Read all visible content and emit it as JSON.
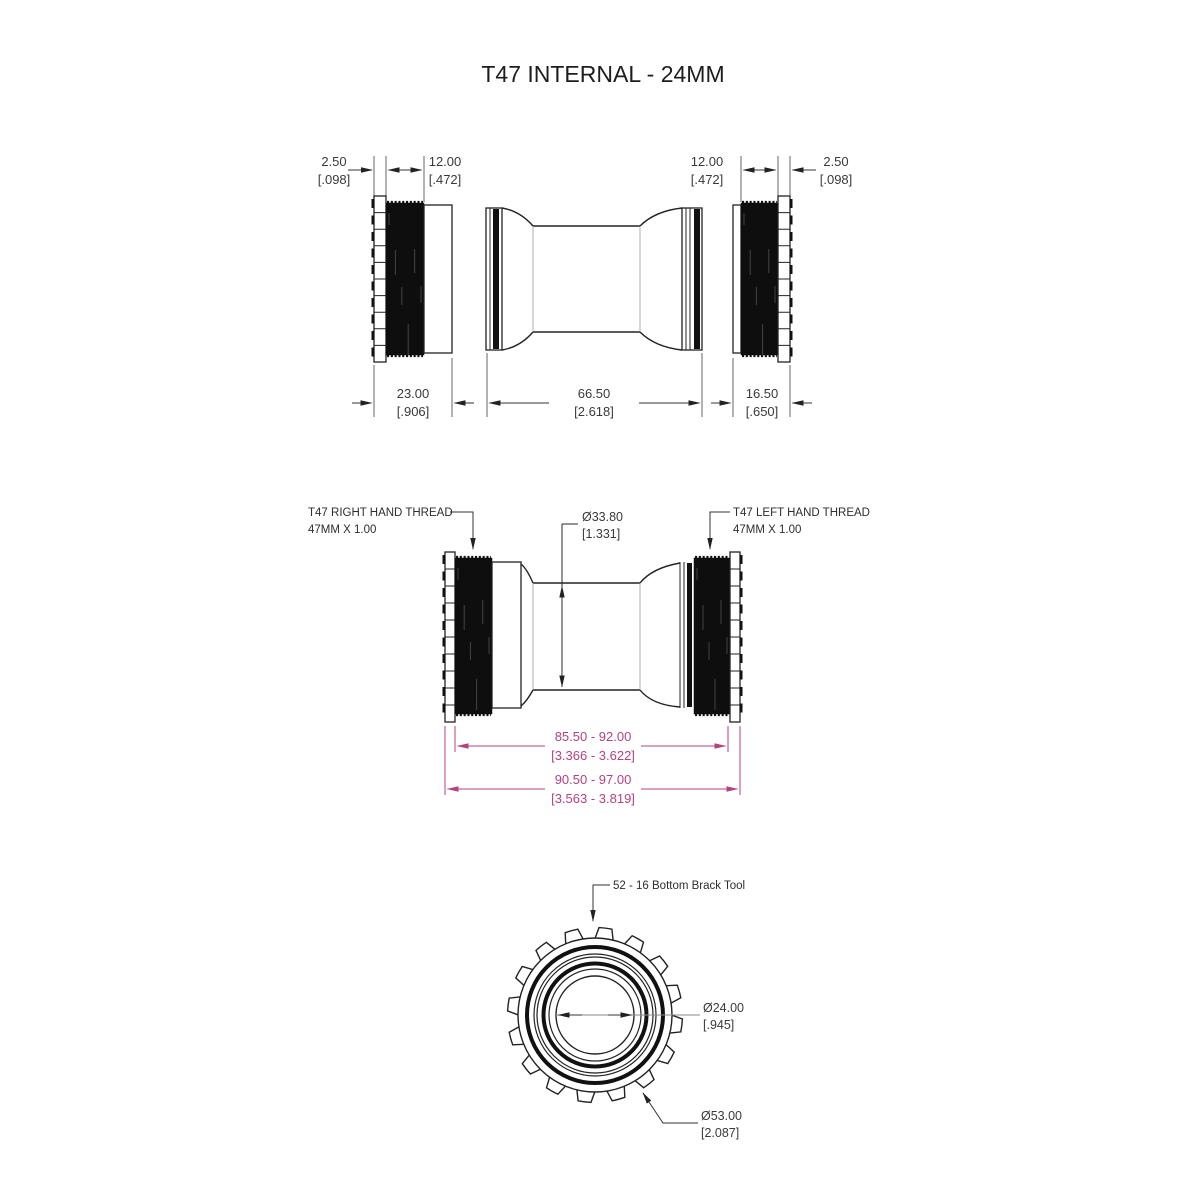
{
  "title": "T47 INTERNAL - 24MM",
  "colors": {
    "ink": "#222222",
    "text": "#3a3a3a",
    "magenta": "#b5437f"
  },
  "top_view": {
    "dim_flange_left": {
      "mm": "2.50",
      "in": "[.098]"
    },
    "dim_thread_left": {
      "mm": "12.00",
      "in": "[.472]"
    },
    "dim_thread_right": {
      "mm": "12.00",
      "in": "[.472]"
    },
    "dim_flange_right": {
      "mm": "2.50",
      "in": "[.098]"
    },
    "dim_left_cup": {
      "mm": "23.00",
      "in": "[.906]"
    },
    "dim_sleeve": {
      "mm": "66.50",
      "in": "[2.618]"
    },
    "dim_right_cup": {
      "mm": "16.50",
      "in": "[.650]"
    }
  },
  "assembled_view": {
    "right_hand_thread": {
      "line1": "T47 RIGHT HAND THREAD",
      "line2": "47MM X 1.00"
    },
    "left_hand_thread": {
      "line1": "T47 LEFT HAND THREAD",
      "line2": "47MM X 1.00"
    },
    "dim_bore": {
      "mm": "Ø33.80",
      "in": "[1.331]"
    },
    "dim_shell_inner": {
      "mm": "85.50 - 92.00",
      "in": "[3.366 - 3.622]"
    },
    "dim_shell_outer": {
      "mm": "90.50 - 97.00",
      "in": "[3.563 - 3.819]"
    }
  },
  "end_view": {
    "tool_label": "52 - 16 Bottom Brack Tool",
    "dim_bore": {
      "mm": "Ø24.00",
      "in": "[.945]"
    },
    "dim_outer": {
      "mm": "Ø53.00",
      "in": "[2.087]"
    }
  }
}
